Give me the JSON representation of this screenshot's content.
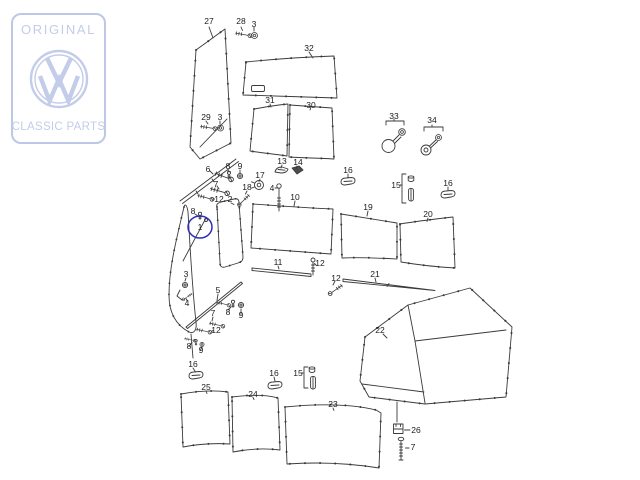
{
  "logo": {
    "top_text": "ORIGINAL",
    "bottom_text": "CLASSIC PARTS",
    "accent_color": "#c3cce9"
  },
  "diagram": {
    "line_color": "#3a3a3a",
    "highlight_color": "#2d2dc2",
    "highlighted_part": "1",
    "numbers": {
      "n1": "1",
      "n2": "2",
      "n3": "3",
      "n4": "4",
      "n5": "5",
      "n6": "6",
      "n7": "7",
      "n8": "8",
      "n9": "9",
      "n10": "10",
      "n11": "11",
      "n12": "12",
      "n13": "13",
      "n14": "14",
      "n15": "15",
      "n16": "16",
      "n17": "17",
      "n18": "18",
      "n19": "19",
      "n20": "20",
      "n21": "21",
      "n22": "22",
      "n23": "23",
      "n24": "24",
      "n25": "25",
      "n26": "26",
      "n27": "27",
      "n28": "28",
      "n29": "29",
      "n30": "30",
      "n31": "31",
      "n32": "32",
      "n33": "33",
      "n34": "34"
    }
  }
}
